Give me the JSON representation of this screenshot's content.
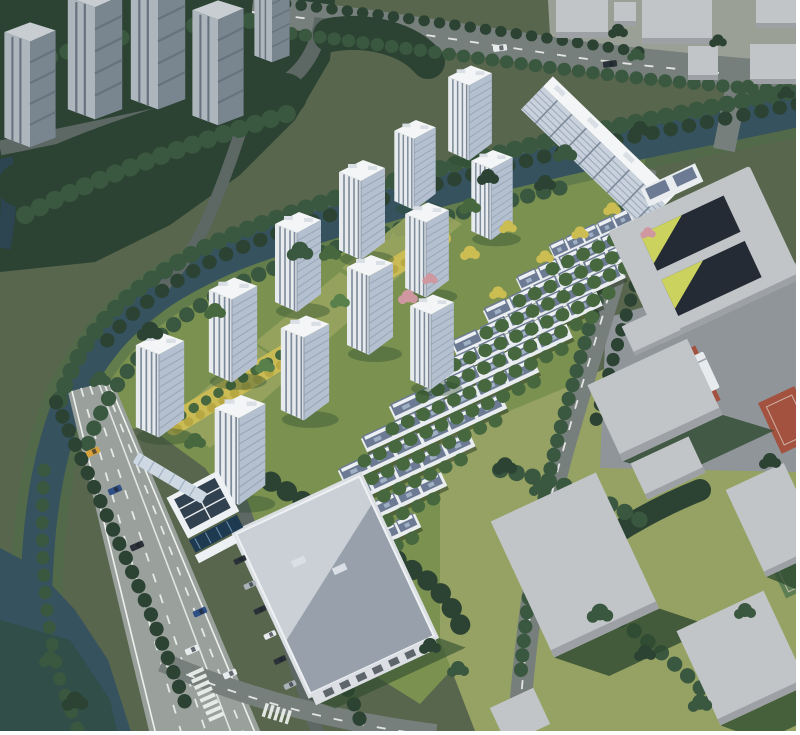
{
  "image": {
    "kind": "aerial architectural rendering",
    "subject": "bird's-eye rendering of a residential community masterplan: white high-rise towers and townhouse rows set in landscaped grounds, wrapped by a tree-lined canal, a wide arterial road at lower-left, clubhouse with solar roof, large warehouse building, school block with courtyards, red sports courts and gray context massing blocks",
    "view": "oblique bird's-eye",
    "width_px": 800,
    "height_px": 735
  },
  "colors": {
    "base_green": "#57664d",
    "forest_dark": "#2c4233",
    "forest_mid": "#3a573f",
    "tree_green": "#47683f",
    "tree_bright": "#59804a",
    "lawn": "#7b9150",
    "lawn_bright": "#97a45f",
    "autumn_yellow": "#ccbd53",
    "blossom_pink": "#cf98a0",
    "water": "#35525e",
    "water_deep": "#2c4551",
    "bank_green": "#4e6b49",
    "road_major": "#9aa19c",
    "road_minor": "#767f7b",
    "road_dark": "#5d6865",
    "lane_white": "#eef1ee",
    "tower_roof": "#f3f5f6",
    "tower_face_lit": "#e7ebee",
    "tower_face_glass": "#b4c0cf",
    "tower_stripe": "#7c8a9a",
    "tower_floor": "#93a1b2",
    "bg_tower_lit": "#aeb6bd",
    "bg_tower_dark": "#79858f",
    "bg_tower_roof": "#c8cdd2",
    "row_wall": "#e9edf0",
    "row_roof": "#6c7b93",
    "row_ridge": "#eef1f4",
    "context_top": "#c2c5c8",
    "context_side": "#9da1a5",
    "school_dark": "#252b35",
    "school_yellow": "#ccd25e",
    "sport_red": "#a3523f",
    "sport_green": "#5d7d53",
    "shadow_green": "#2e4a2f",
    "solar_dark": "#32414f",
    "pool_blue": "#1e3a51",
    "warehouse_lit": "#cad0d5",
    "warehouse_shade": "#98a1ab",
    "border_white": "#ffffff"
  },
  "scene": {
    "site": {
      "highrise_tower_count": 12,
      "residential_slab_count": 1,
      "townhouse_row_count": 11,
      "landscape_bands": 2
    },
    "context": {
      "background_tower_count": 5,
      "gray_block_count": 6,
      "red_court_count": 2,
      "green_court_count": 2,
      "school_courtyard_count": 2
    },
    "roads": {
      "main_road_moving_car_count": 6,
      "parked_car_count": 6,
      "crosswalk_count": 2
    },
    "water": {
      "label": "canal"
    }
  }
}
